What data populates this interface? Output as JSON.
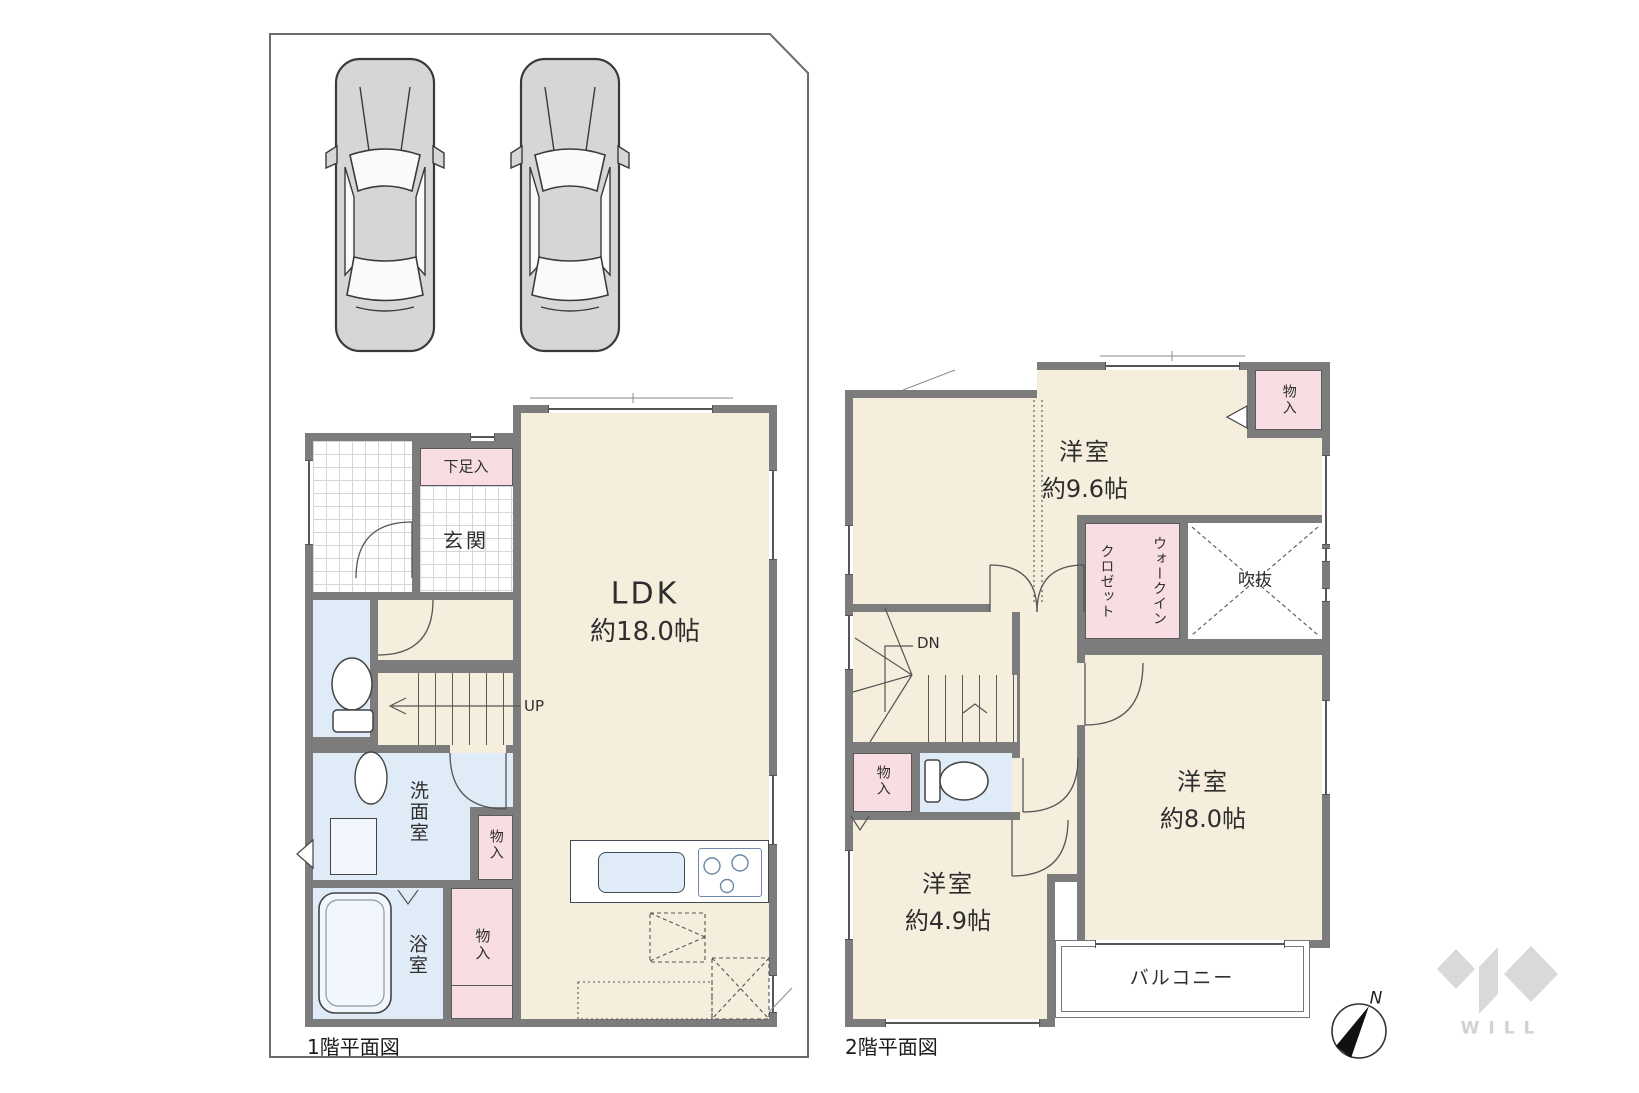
{
  "floor1": {
    "caption": "1階平面図",
    "entrance": "玄関",
    "shoe_storage": "下足入",
    "ldk_name": "LDK",
    "ldk_size": "約18.0帖",
    "stairs": "UP",
    "washroom": "洗面室",
    "storage_hall": "物入",
    "bathroom": "浴室",
    "storage_bath": "物入"
  },
  "floor2": {
    "caption": "2階平面図",
    "room_96_name": "洋室",
    "room_96_size": "約9.6帖",
    "room_80_name": "洋室",
    "room_80_size": "約8.0帖",
    "room_49_name": "洋室",
    "room_49_size": "約4.9帖",
    "wic_line1": "ウォークイン",
    "wic_line2": "クロゼット",
    "void_label": "吹抜",
    "stairs": "DN",
    "storage_top": "物入",
    "storage_hall": "物入",
    "balcony": "バルコニー"
  },
  "compass": {
    "label": "N"
  },
  "brand": {
    "logo_text": "WILL"
  },
  "colors": {
    "wall": "#7c7c7c",
    "room_fill": "#f6eedd",
    "wet_fill": "#dfebf7",
    "storage_fill": "#f8dee2",
    "boundary": "#6b6b6b",
    "logo_gray": "#d9d9d9"
  }
}
